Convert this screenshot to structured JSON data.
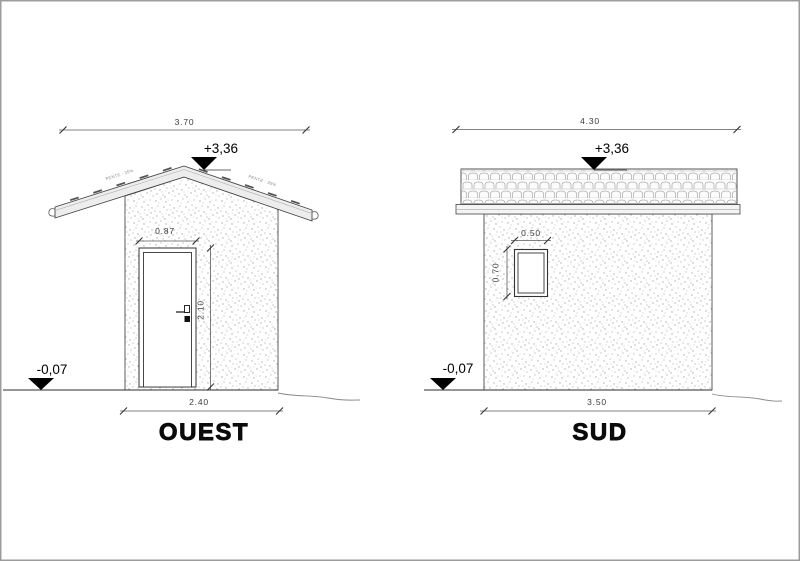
{
  "drawing": {
    "ouest": {
      "title": "OUEST",
      "overall_width": "3.70",
      "ridge_level": "+3,36",
      "ground_level": "-0,07",
      "door_width": "0.87",
      "door_height": "2.10",
      "facade_width": "2.40",
      "roof_slope_left": "PENTE : 35%",
      "roof_slope_right": "PENTE : 35%"
    },
    "sud": {
      "title": "SUD",
      "overall_width": "4.30",
      "ridge_level": "+3,36",
      "ground_level": "-0,07",
      "window_width": "0.50",
      "window_height": "0.70",
      "facade_width": "3.50"
    },
    "colors": {
      "line": "#3c3c3c",
      "dimension_text": "#3a3a3a",
      "texture_dots": "#ababab",
      "roof_fill": "#ededed",
      "level_marker": "#000000",
      "page_border": "#9c9c9c"
    }
  }
}
